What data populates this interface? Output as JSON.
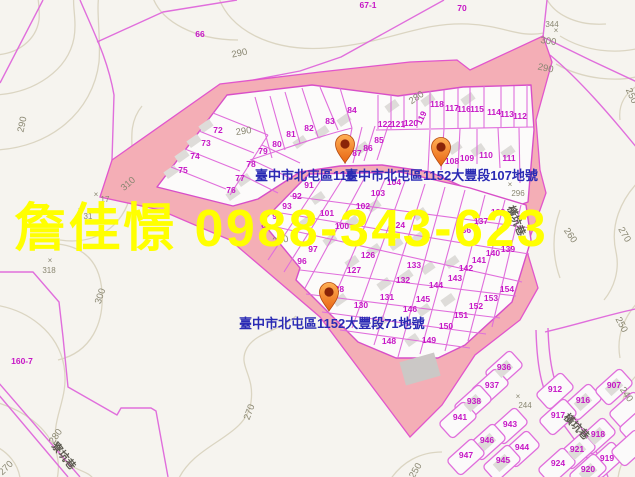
{
  "window": {
    "width": 635,
    "height": 477
  },
  "map_kind": "cadastral-parcel-map",
  "colors": {
    "background": "#f6f4ef",
    "highlight_pink": "#f4aeb6",
    "cadastral_magenta": "#e06edc",
    "parcel_number_magenta": "#c617c6",
    "contour_line": "#dbd5c2",
    "contour_label_grey": "#8a8772",
    "marker_label_blue": "#2a2ab4",
    "watermark_yellow": "#ffff00",
    "pin_orange": "#f08c1e"
  },
  "watermark": {
    "text": "詹佳憬 0988-343-623"
  },
  "markers": [
    {
      "label": "臺中市北屯區115",
      "pin": {
        "x": 345,
        "y": 163
      },
      "label_pos": {
        "x": 255,
        "y": 180
      }
    },
    {
      "label": "臺中市北屯區1152大豐段107地號",
      "pin": {
        "x": 441,
        "y": 166
      },
      "label_pos": {
        "x": 345,
        "y": 180
      }
    },
    {
      "label": "臺中市北屯區1152大豐段71地號",
      "pin": {
        "x": 329,
        "y": 311
      },
      "label_pos": {
        "x": 239,
        "y": 328
      }
    }
  ],
  "parcel_numbers": [
    {
      "n": "66",
      "x": 200,
      "y": 37,
      "s": 9
    },
    {
      "n": "67-1",
      "x": 368,
      "y": 8,
      "s": 9
    },
    {
      "n": "70",
      "x": 462,
      "y": 11,
      "s": 9
    },
    {
      "n": "160-7",
      "x": 22,
      "y": 364,
      "s": 9
    },
    {
      "n": "72",
      "x": 218,
      "y": 133
    },
    {
      "n": "73",
      "x": 206,
      "y": 146
    },
    {
      "n": "74",
      "x": 195,
      "y": 159
    },
    {
      "n": "75",
      "x": 183,
      "y": 173
    },
    {
      "n": "76",
      "x": 231,
      "y": 193
    },
    {
      "n": "77",
      "x": 240,
      "y": 181
    },
    {
      "n": "78",
      "x": 251,
      "y": 167
    },
    {
      "n": "79",
      "x": 263,
      "y": 154
    },
    {
      "n": "80",
      "x": 277,
      "y": 147
    },
    {
      "n": "81",
      "x": 291,
      "y": 137
    },
    {
      "n": "82",
      "x": 309,
      "y": 131
    },
    {
      "n": "83",
      "x": 330,
      "y": 124
    },
    {
      "n": "84",
      "x": 352,
      "y": 113
    },
    {
      "n": "85",
      "x": 379,
      "y": 143
    },
    {
      "n": "86",
      "x": 368,
      "y": 151
    },
    {
      "n": "87",
      "x": 357,
      "y": 156
    },
    {
      "n": "122",
      "x": 385,
      "y": 127
    },
    {
      "n": "121",
      "x": 398,
      "y": 127
    },
    {
      "n": "120",
      "x": 411,
      "y": 126
    },
    {
      "n": "119",
      "x": 424,
      "y": 119,
      "r": -65
    },
    {
      "n": "118",
      "x": 437,
      "y": 107
    },
    {
      "n": "117",
      "x": 452,
      "y": 111
    },
    {
      "n": "116",
      "x": 464,
      "y": 112
    },
    {
      "n": "115",
      "x": 477,
      "y": 112
    },
    {
      "n": "114",
      "x": 494,
      "y": 115
    },
    {
      "n": "113",
      "x": 507,
      "y": 117
    },
    {
      "n": "112",
      "x": 520,
      "y": 119
    },
    {
      "n": "108",
      "x": 452,
      "y": 164
    },
    {
      "n": "109",
      "x": 467,
      "y": 161
    },
    {
      "n": "110",
      "x": 486,
      "y": 158
    },
    {
      "n": "111",
      "x": 509,
      "y": 161
    },
    {
      "n": "104",
      "x": 394,
      "y": 185
    },
    {
      "n": "103",
      "x": 378,
      "y": 196
    },
    {
      "n": "102",
      "x": 363,
      "y": 209
    },
    {
      "n": "101",
      "x": 327,
      "y": 216
    },
    {
      "n": "100",
      "x": 342,
      "y": 229
    },
    {
      "n": "91",
      "x": 309,
      "y": 188
    },
    {
      "n": "92",
      "x": 297,
      "y": 199
    },
    {
      "n": "93",
      "x": 287,
      "y": 209
    },
    {
      "n": "94",
      "x": 277,
      "y": 219
    },
    {
      "n": "95",
      "x": 266,
      "y": 230
    },
    {
      "n": "97",
      "x": 313,
      "y": 252
    },
    {
      "n": "96",
      "x": 302,
      "y": 264
    },
    {
      "n": "124",
      "x": 398,
      "y": 228
    },
    {
      "n": "138",
      "x": 498,
      "y": 215
    },
    {
      "n": "137",
      "x": 481,
      "y": 224
    },
    {
      "n": "136",
      "x": 464,
      "y": 233
    },
    {
      "n": "126",
      "x": 368,
      "y": 258
    },
    {
      "n": "127",
      "x": 354,
      "y": 273
    },
    {
      "n": "128",
      "x": 337,
      "y": 292
    },
    {
      "n": "130",
      "x": 361,
      "y": 308
    },
    {
      "n": "131",
      "x": 387,
      "y": 300
    },
    {
      "n": "132",
      "x": 403,
      "y": 283
    },
    {
      "n": "133",
      "x": 414,
      "y": 268
    },
    {
      "n": "139",
      "x": 508,
      "y": 252
    },
    {
      "n": "140",
      "x": 493,
      "y": 256
    },
    {
      "n": "141",
      "x": 479,
      "y": 263
    },
    {
      "n": "142",
      "x": 466,
      "y": 271
    },
    {
      "n": "143",
      "x": 455,
      "y": 281
    },
    {
      "n": "144",
      "x": 436,
      "y": 288
    },
    {
      "n": "145",
      "x": 423,
      "y": 302
    },
    {
      "n": "146",
      "x": 410,
      "y": 312
    },
    {
      "n": "148",
      "x": 389,
      "y": 344
    },
    {
      "n": "149",
      "x": 429,
      "y": 343
    },
    {
      "n": "150",
      "x": 446,
      "y": 329
    },
    {
      "n": "151",
      "x": 461,
      "y": 318
    },
    {
      "n": "152",
      "x": 476,
      "y": 309
    },
    {
      "n": "153",
      "x": 491,
      "y": 301
    },
    {
      "n": "154",
      "x": 507,
      "y": 292
    },
    {
      "n": "936",
      "x": 504,
      "y": 370
    },
    {
      "n": "937",
      "x": 492,
      "y": 388
    },
    {
      "n": "938",
      "x": 474,
      "y": 404
    },
    {
      "n": "941",
      "x": 460,
      "y": 420
    },
    {
      "n": "943",
      "x": 510,
      "y": 427
    },
    {
      "n": "944",
      "x": 522,
      "y": 450
    },
    {
      "n": "945",
      "x": 503,
      "y": 463
    },
    {
      "n": "946",
      "x": 487,
      "y": 443
    },
    {
      "n": "947",
      "x": 466,
      "y": 458
    },
    {
      "n": "907",
      "x": 614,
      "y": 388
    },
    {
      "n": "912",
      "x": 555,
      "y": 392
    },
    {
      "n": "916",
      "x": 583,
      "y": 403
    },
    {
      "n": "917",
      "x": 558,
      "y": 418
    },
    {
      "n": "918",
      "x": 598,
      "y": 437
    },
    {
      "n": "919",
      "x": 607,
      "y": 461
    },
    {
      "n": "920",
      "x": 588,
      "y": 472
    },
    {
      "n": "921",
      "x": 577,
      "y": 452
    },
    {
      "n": "924",
      "x": 558,
      "y": 466
    }
  ],
  "contour_labels": [
    {
      "t": "290",
      "x": 25,
      "y": 125,
      "r": -78
    },
    {
      "t": "290",
      "x": 240,
      "y": 56,
      "r": -12
    },
    {
      "t": "290",
      "x": 244,
      "y": 134,
      "r": -8
    },
    {
      "t": "280",
      "x": 418,
      "y": 100,
      "r": -35
    },
    {
      "t": "310",
      "x": 130,
      "y": 186,
      "r": -42
    },
    {
      "t": "300",
      "x": 103,
      "y": 297,
      "r": -72
    },
    {
      "t": "300",
      "x": 548,
      "y": 44,
      "r": 8
    },
    {
      "t": "290",
      "x": 545,
      "y": 71,
      "r": 12
    },
    {
      "t": "250",
      "x": 629,
      "y": 97,
      "r": 65
    },
    {
      "t": "270",
      "x": 622,
      "y": 236,
      "r": 60
    },
    {
      "t": "260",
      "x": 568,
      "y": 237,
      "r": 55
    },
    {
      "t": "250",
      "x": 619,
      "y": 326,
      "r": 62
    },
    {
      "t": "240",
      "x": 624,
      "y": 396,
      "r": 55
    },
    {
      "t": "270",
      "x": 252,
      "y": 413,
      "r": -70
    },
    {
      "t": "280",
      "x": 58,
      "y": 438,
      "r": -55
    },
    {
      "t": "270",
      "x": 8,
      "y": 470,
      "r": -45
    },
    {
      "t": "250",
      "x": 418,
      "y": 472,
      "r": -60
    },
    {
      "t": "280",
      "x": 281,
      "y": 243,
      "r": -10
    }
  ],
  "spot_heights": [
    {
      "v": "318",
      "mx": 50,
      "my": 263,
      "tx": 49,
      "ty": 273
    },
    {
      "v": "17",
      "mx": 96,
      "my": 197,
      "tx": 105,
      "ty": 202
    },
    {
      "v": "31",
      "mx": 80,
      "my": 213,
      "tx": 88,
      "ty": 219
    },
    {
      "v": "344",
      "mx": 556,
      "my": 33,
      "tx": 552,
      "ty": 27
    },
    {
      "v": "296",
      "mx": 510,
      "my": 187,
      "tx": 518,
      "ty": 196
    },
    {
      "v": "244",
      "mx": 518,
      "my": 399,
      "tx": 525,
      "ty": 408
    }
  ],
  "road_labels": [
    {
      "t": "橫坑巷",
      "x": 513,
      "y": 222,
      "r": 68
    },
    {
      "t": "橫坑巷",
      "x": 574,
      "y": 429,
      "r": 46
    },
    {
      "t": "寮坑巷",
      "x": 61,
      "y": 458,
      "r": 52
    }
  ]
}
